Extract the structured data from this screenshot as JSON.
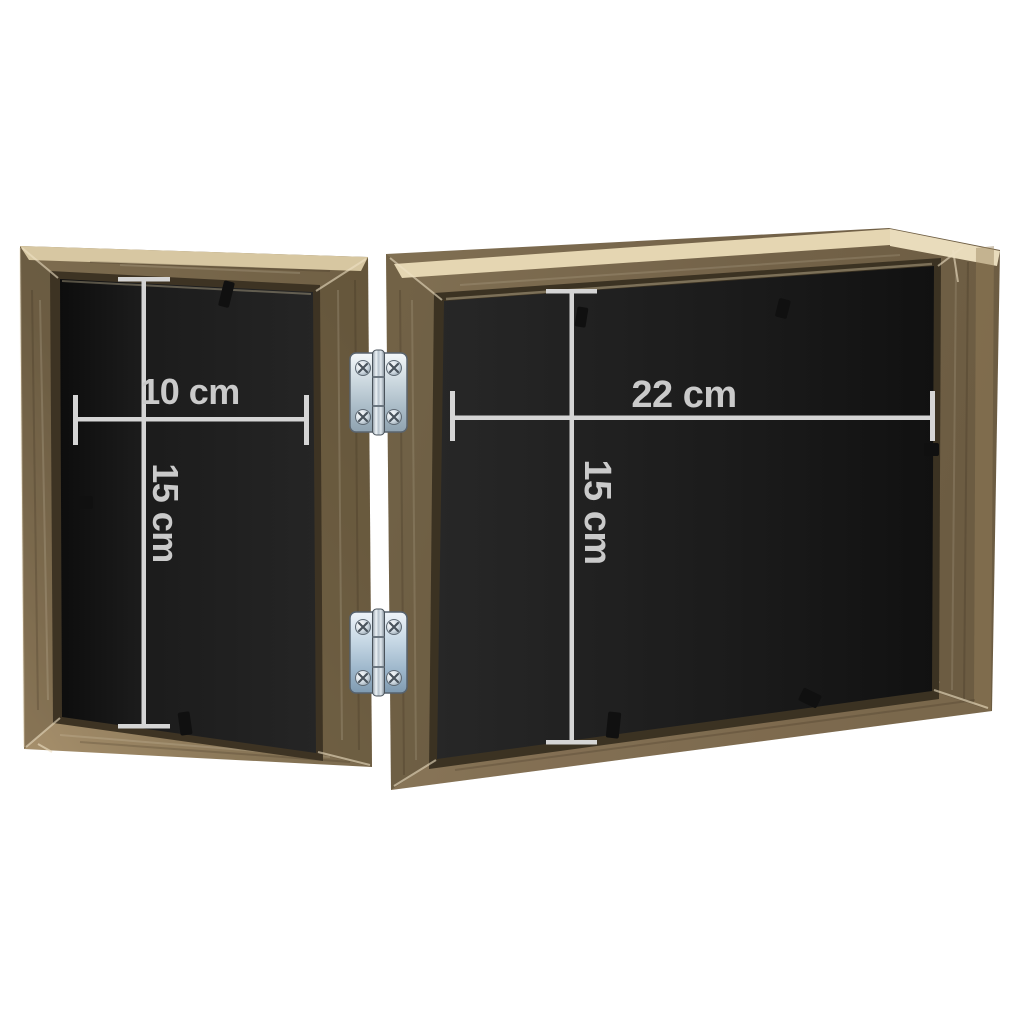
{
  "scene": {
    "description": "Back view of a hinged double wooden photo frame with white measurement annotations",
    "background": "#ffffff"
  },
  "dimensions": {
    "left_width": "10 cm",
    "left_height": "15 cm",
    "right_width": "22 cm",
    "right_height": "15 cm"
  },
  "colors": {
    "wood_mid": "#7b6a4e",
    "wood_light": "#a8916d",
    "wood_dark": "#635438",
    "wood_top_face": "#e8dab8",
    "interior_black": "#1c1c1c",
    "dimension_line": "#d5d5d5",
    "dimension_text": "#cacaca",
    "hinge_silver": "#c6d2da",
    "background": "#ffffff"
  }
}
